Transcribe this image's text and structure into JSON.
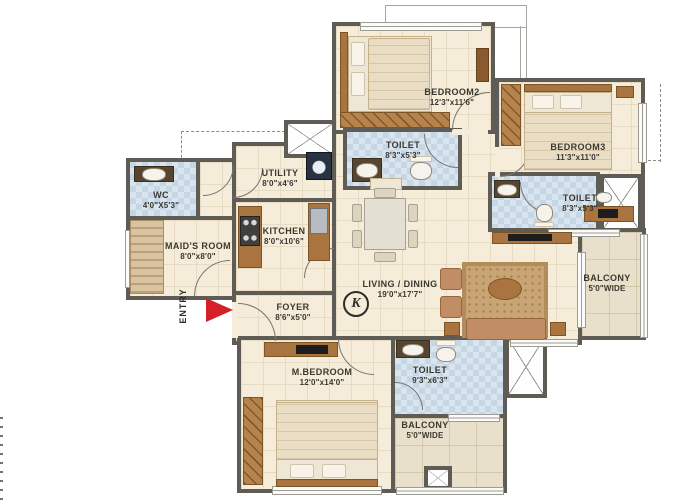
{
  "plan": {
    "marker_letter": "K",
    "entry": {
      "label": "ENTRY"
    },
    "rooms": [
      {
        "id": "bedroom2",
        "name": "BEDROOM2",
        "dims": "12'3\"x11'6\""
      },
      {
        "id": "bedroom3",
        "name": "BEDROOM3",
        "dims": "11'3\"x11'0\""
      },
      {
        "id": "toilet_top",
        "name": "TOILET",
        "dims": "8'3\"x5'3\""
      },
      {
        "id": "toilet_right",
        "name": "TOILET",
        "dims": "8'3\"x5'3\""
      },
      {
        "id": "utility",
        "name": "UTILITY",
        "dims": "8'0\"x4'6\""
      },
      {
        "id": "kitchen",
        "name": "KITCHEN",
        "dims": "8'0\"x10'6\""
      },
      {
        "id": "wc",
        "name": "WC",
        "dims": "4'0\"X5'3\""
      },
      {
        "id": "maids_room",
        "name": "MAID'S ROOM",
        "dims": "8'0\"x8'0\""
      },
      {
        "id": "living_dining",
        "name": "LIVING / DINING",
        "dims": "19'0\"x17'7\""
      },
      {
        "id": "foyer",
        "name": "FOYER",
        "dims": "8'6\"x5'0\""
      },
      {
        "id": "master_bedroom",
        "name": "M.BEDROOM",
        "dims": "12'0\"x14'0\""
      },
      {
        "id": "toilet_master",
        "name": "TOILET",
        "dims": "9'3\"x6'3\""
      },
      {
        "id": "balcony_right",
        "name": "BALCONY",
        "dims": "5'0\"WIDE"
      },
      {
        "id": "balcony_bottom",
        "name": "BALCONY",
        "dims": "5'0\"WIDE"
      }
    ],
    "colors": {
      "wall": "#5e5c55",
      "floor": "#f5ecd9",
      "bath_tile": "#c5d6e4",
      "balcony_tile": "#e9e0cb",
      "wood": "#b5834b",
      "entry_arrow": "#d42127",
      "text": "#3b3831"
    }
  }
}
